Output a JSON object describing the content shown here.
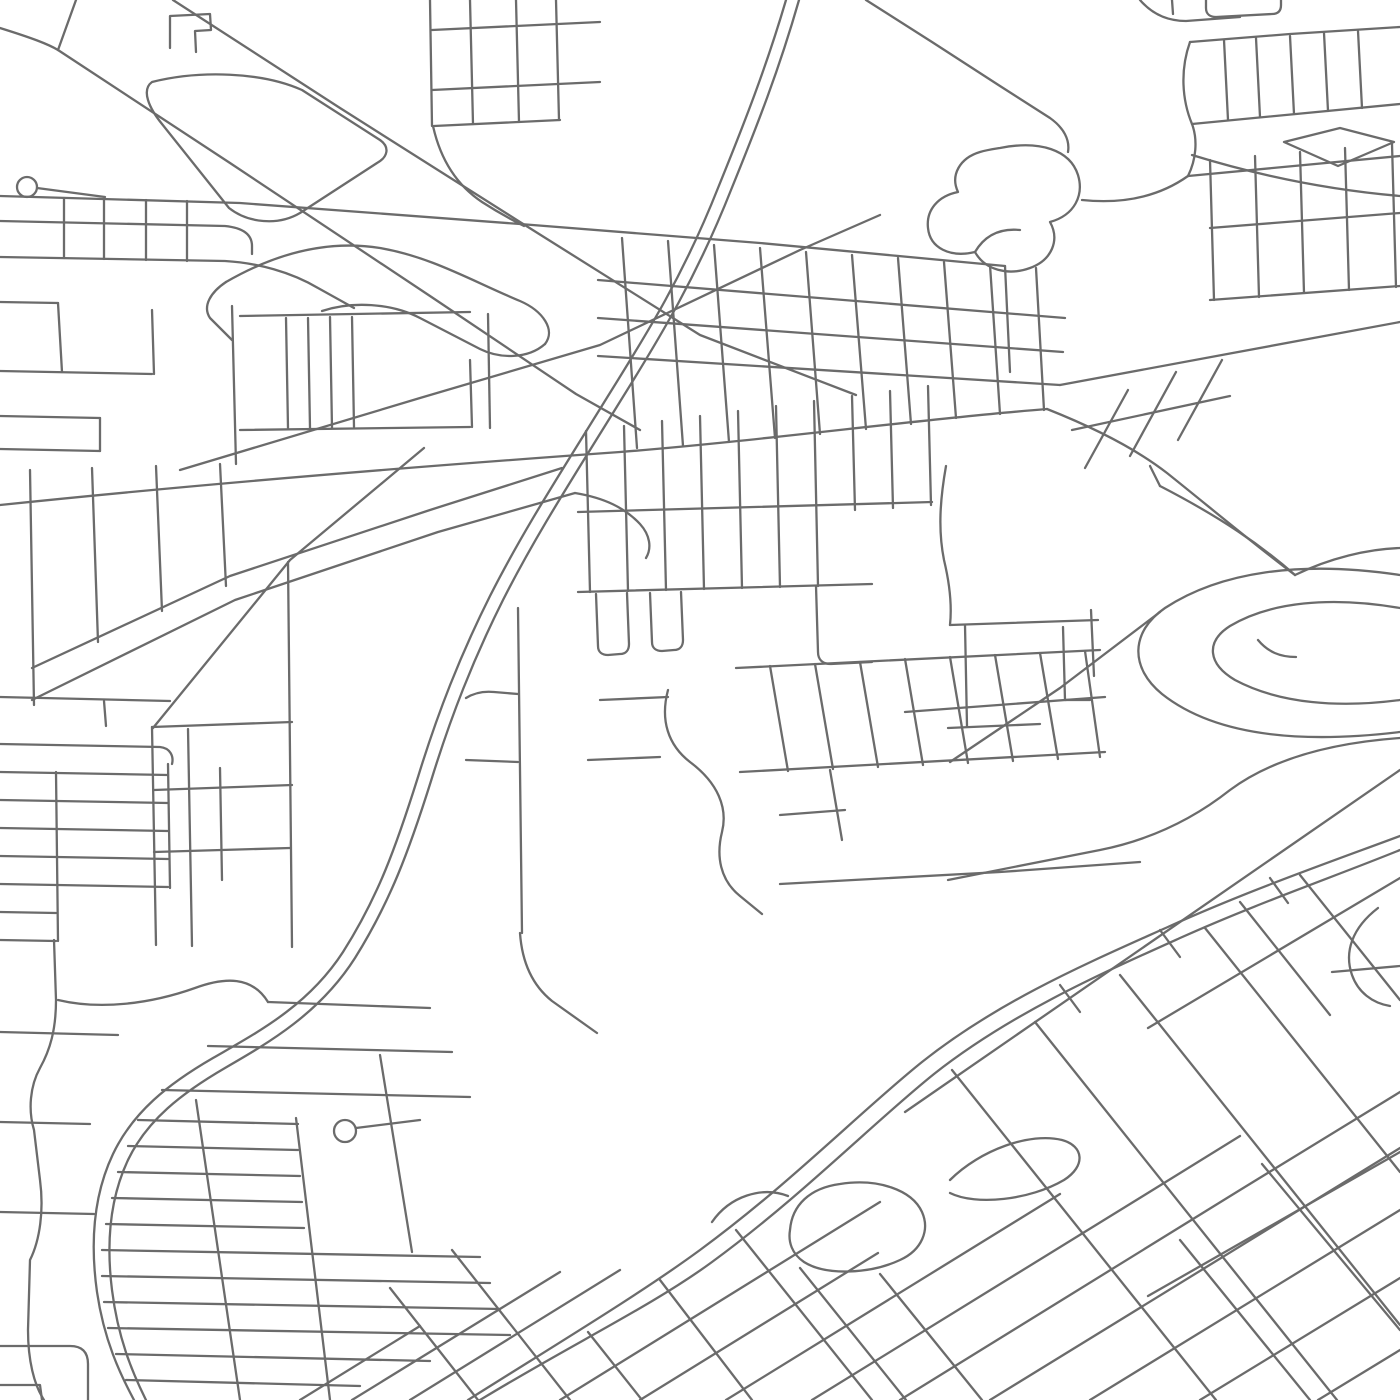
{
  "map": {
    "background_color": "#ffffff",
    "road_color": "#6b6b6b",
    "road_width": 2.3,
    "canvas": {
      "width": 1400,
      "height": 1400
    },
    "cul_de_sacs": [
      {
        "cx": 27,
        "cy": 187,
        "r": 10
      },
      {
        "cx": 345,
        "cy": 1131,
        "r": 11
      }
    ],
    "roads": [
      "M 786 0 C 766 68 744 124 718 188 C 684 274 648 332 608 396 C 558 477 523 531 490 596 C 460 656 438 712 418 777 C 396 847 378 897 343 952 C 308 1006 258 1032 213 1058 C 168 1084 133 1112 113 1154 C 94 1194 90 1242 97 1292 C 104 1340 120 1374 134 1400",
      "M 799 0 C 779 70 757 126 731 190 C 697 276 661 336 621 400 C 571 481 536 535 503 600 C 473 660 451 716 431 781 C 409 851 390 902 355 958 C 320 1013 270 1042 225 1068 C 182 1093 147 1120 128 1160 C 110 1198 106 1242 112 1290 C 118 1338 132 1372 146 1400",
      "M 468 1400 C 560 1342 640 1294 700 1250 C 790 1184 862 1110 922 1062 C 1000 1000 1090 962 1170 926 C 1250 890 1330 862 1400 836",
      "M 480 1400 C 572 1344 652 1306 712 1262 C 802 1196 874 1122 934 1074 C 1010 1014 1100 974 1180 938 C 1258 903 1336 876 1400 850",
      "M 905 1112 L 1400 770",
      "M 1160 612 L 1060 688 L 950 762",
      "M 0 505 C 240 480 480 462 620 452 C 760 441 920 419 1047 409",
      "M 1047 409 C 1100 430 1140 452 1167 473 C 1212 509 1256 546 1295 575",
      "M 1060 385 C 1160 367 1300 340 1400 322",
      "M 0 196 L 240 203 L 520 224 L 760 243 L 1005 266",
      "M 1005 266 L 1010 372",
      "M 598 280 L 1065 318",
      "M 598 318 L 1063 352",
      "M 598 356 L 1060 385",
      "M 622 238 L 637 448",
      "M 668 241 L 683 446",
      "M 714 245 L 729 442",
      "M 760 248 L 775 438",
      "M 806 252 L 820 434",
      "M 852 255 L 866 429",
      "M 898 258 L 911 424",
      "M 944 262 L 956 418",
      "M 990 265 L 1000 414",
      "M 1036 268 L 1044 410",
      "M 1085 468 L 1128 390",
      "M 1130 456 L 1176 372",
      "M 1178 440 L 1222 360",
      "M 1072 430 L 1230 396",
      "M 430 0 L 432 126",
      "M 470 0 L 473 124",
      "M 516 0 L 519 122",
      "M 556 0 L 559 120",
      "M 432 30 L 600 22",
      "M 432 90 L 600 82",
      "M 434 126 L 560 120",
      "M 433 126 C 441 162 458 186 482 202 C 496 211 510 219 524 226",
      "M 170 48 L 170 16 L 210 14 L 211 30 L 195 31 L 196 52",
      "M 0 28 C 32 38 48 44 58 50 L 230 163 L 430 296 L 576 394 L 640 430",
      "M 76 0 L 58 50",
      "M 173 0 L 340 108 L 520 222 L 700 335 L 856 395",
      "M 180 470 L 420 398 L 600 345 L 800 250 L 880 215",
      "M 152 82 C 200 70 262 72 302 90 L 380 140 C 390 147 388 157 377 163 L 300 213 C 278 226 248 223 229 208 L 162 124 C 149 108 141 90 152 82 Z",
      "M 226 282 C 278 252 330 240 380 248 C 432 257 472 281 520 301 C 543 311 556 330 545 344",
      "M 226 282 C 211 292 202 306 210 318 L 232 340",
      "M 545 344 C 528 359 500 359 480 349 L 420 318 C 391 303 352 301 322 311",
      "M 37 188 L 105 197",
      "M 0 221 L 225 226 C 245 228 252 236 252 246 L 252 254",
      "M 0 257 L 225 261 C 258 263 291 272 318 288 L 354 308",
      "M 64 198 L 64 258",
      "M 104 199 L 104 259",
      "M 146 200 L 146 260",
      "M 187 201 L 187 261",
      "M 0 302 L 58 303",
      "M 58 303 L 62 372",
      "M 0 371 L 152 374",
      "M 152 310 L 154 374",
      "M 0 416 L 100 418",
      "M 0 449 L 100 451",
      "M 100 418 L 100 451",
      "M 232 306 L 236 464",
      "M 240 316 L 470 312",
      "M 240 430 L 470 427",
      "M 286 318 L 288 428",
      "M 308 318 L 310 428",
      "M 330 317 L 332 428",
      "M 352 317 L 354 427",
      "M 470 360 L 472 427",
      "M 488 314 L 490 428",
      "M 30 470 L 34 705",
      "M 92 468 L 98 642",
      "M 156 466 L 162 611",
      "M 220 464 L 226 586",
      "M 32 668 L 230 576 L 430 510 L 562 468",
      "M 32 700 L 235 600 L 438 532 L 575 493",
      "M 575 493 C 605 498 625 508 640 524 C 650 535 652 548 646 558",
      "M 0 697 L 170 701",
      "M 104 701 L 106 726",
      "M 0 744 L 160 747 C 170 748 174 756 172 764",
      "M 0 772 L 168 775",
      "M 0 800 L 168 803",
      "M 0 828 L 168 831",
      "M 0 856 L 168 859",
      "M 0 884 L 168 887",
      "M 0 912 L 56 913",
      "M 0 940 L 56 941",
      "M 56 772 L 58 941",
      "M 168 764 L 170 888",
      "M 152 727 L 292 722",
      "M 154 790 L 292 785",
      "M 154 852 L 290 848",
      "M 152 727 L 156 945",
      "M 188 729 L 192 946",
      "M 288 562 L 292 947",
      "M 153 728 L 290 560 L 424 448",
      "M 220 768 L 222 880",
      "M 518 608 L 522 933",
      "M 466 698 C 474 693 484 691 494 692 L 518 694",
      "M 466 760 L 518 762",
      "M 520 933 C 522 962 532 985 552 1001 L 597 1033",
      "M 578 512 L 932 502",
      "M 578 592 L 872 584",
      "M 586 431 L 590 592",
      "M 624 426 L 628 591",
      "M 662 421 L 666 590",
      "M 700 416 L 704 589",
      "M 738 411 L 742 588",
      "M 776 406 L 780 587",
      "M 814 401 L 818 586",
      "M 852 396 L 855 510",
      "M 890 391 L 893 508",
      "M 928 386 L 931 505",
      "M 596 594 L 598 646 C 598 652 602 655 608 655 L 620 654 C 626 654 629 650 629 644 L 627 593",
      "M 650 593 L 652 642 C 652 648 656 651 662 651 L 674 650 C 680 650 683 646 683 640 L 681 592",
      "M 816 586 L 818 652 C 818 660 823 664 831 664 L 872 662",
      "M 668 690 C 660 720 668 745 690 762 C 718 783 728 808 722 832 C 716 856 720 880 740 896 L 762 914",
      "M 600 700 L 668 697",
      "M 588 760 L 660 757",
      "M 736 668 L 1100 650",
      "M 740 772 L 1105 752",
      "M 770 666 L 788 771",
      "M 815 664 L 833 769",
      "M 860 662 L 878 767",
      "M 905 659 L 923 765",
      "M 950 657 L 968 763",
      "M 995 655 L 1013 761",
      "M 1040 653 L 1058 759",
      "M 1085 651 L 1100 757",
      "M 905 712 L 1105 697",
      "M 780 815 L 845 810",
      "M 780 884 L 1000 872 L 1140 862",
      "M 830 770 L 842 840",
      "M 946 466 C 940 500 938 530 944 560 C 950 585 952 606 950 625",
      "M 950 625 L 1098 620",
      "M 1091 610 L 1094 676",
      "M 965 625 L 967 726",
      "M 948 728 L 1040 724",
      "M 1063 627 L 1065 700 L 1090 700",
      "M 1400 575 C 1300 560 1220 572 1165 608 C 1130 632 1130 668 1162 694 C 1215 736 1300 744 1400 732",
      "M 1400 608 C 1330 596 1270 602 1230 626 C 1205 642 1208 664 1235 680 C 1280 704 1340 708 1400 700",
      "M 1258 640 C 1268 652 1280 657 1296 657",
      "M 1160 486 C 1222 518 1262 546 1295 575",
      "M 1295 575 C 1330 558 1368 549 1400 548",
      "M 948 880 L 1100 850 C 1150 840 1192 820 1230 790 C 1272 759 1330 743 1400 738",
      "M 1160 486 L 1150 466",
      "M 1206 0 L 1206 8 C 1206 14 1210 17 1216 17 L 1272 14 C 1278 14 1281 11 1281 5 L 1281 0",
      "M 1140 0 C 1152 14 1168 21 1186 21 L 1240 17",
      "M 1172 0 L 1173 14",
      "M 1190 42 C 1180 70 1182 100 1192 124 C 1198 140 1196 160 1188 176",
      "M 1190 42 L 1290 34 L 1400 27",
      "M 1224 40 L 1228 120",
      "M 1256 38 L 1260 117",
      "M 1290 36 L 1294 114",
      "M 1324 33 L 1328 111",
      "M 1358 31 L 1362 108",
      "M 1192 124 L 1400 104",
      "M 1188 176 L 1400 156",
      "M 1284 142 L 1340 128 L 1394 142 L 1338 166 Z",
      "M 1192 155 C 1260 176 1330 190 1400 196",
      "M 866 0 L 932 42 L 1000 86 L 1050 118 C 1064 128 1070 140 1068 152",
      "M 1000 148 C 1040 140 1070 150 1078 175 C 1084 195 1075 215 1050 222 C 1060 240 1052 260 1030 268 C 1008 276 985 270 975 252 C 950 258 930 248 928 228 C 926 210 938 196 958 192 C 950 175 960 158 980 152 C 987 150 994 149 1000 148 Z",
      "M 975 252 C 985 235 1000 228 1020 230",
      "M 1082 200 C 1130 205 1164 193 1188 176",
      "M 1210 160 L 1214 300",
      "M 1255 156 L 1259 297",
      "M 1300 152 L 1304 293",
      "M 1345 148 L 1349 290",
      "M 1392 144 L 1396 287",
      "M 1210 228 L 1400 213",
      "M 1210 300 L 1400 286",
      "M 54 940 L 56 1000 C 56 1030 50 1050 40 1068 C 30 1086 28 1110 34 1130 L 40 1180 C 44 1210 40 1240 30 1260 L 28 1330 C 28 1360 34 1385 44 1400",
      "M 0 1032 L 118 1035",
      "M 0 1122 L 90 1124",
      "M 0 1212 L 94 1214",
      "M 0 1346 L 70 1346 C 82 1346 88 1352 88 1364 L 88 1400",
      "M 0 1385 L 40 1385 L 42 1400",
      "M 58 1000 C 100 1010 150 1004 195 988 C 225 977 252 976 268 1002",
      "M 268 1002 L 430 1008",
      "M 208 1046 L 452 1052",
      "M 162 1090 L 470 1097",
      "M 138 1120 L 298 1124",
      "M 128 1146 L 298 1150",
      "M 118 1172 L 300 1176",
      "M 112 1198 L 302 1202",
      "M 106 1224 L 304 1228",
      "M 102 1250 L 480 1257",
      "M 102 1276 L 490 1283",
      "M 104 1302 L 500 1309",
      "M 108 1328 L 510 1335",
      "M 116 1354 L 430 1361",
      "M 126 1380 L 360 1386",
      "M 196 1100 L 240 1400",
      "M 296 1118 L 330 1400",
      "M 380 1055 L 412 1252",
      "M 356 1128 L 420 1120",
      "M 300 1400 L 420 1326",
      "M 352 1400 L 560 1272",
      "M 410 1400 L 620 1270",
      "M 560 1400 L 880 1202",
      "M 640 1400 L 878 1253",
      "M 726 1400 L 940 1268 L 1060 1194",
      "M 812 1400 L 1130 1204 L 1240 1136",
      "M 900 1400 L 1240 1190 L 1400 1092",
      "M 990 1400 L 1400 1148",
      "M 1090 1400 L 1400 1210",
      "M 1200 1400 L 1400 1278",
      "M 1318 1400 L 1400 1350",
      "M 1148 1028 L 1400 878",
      "M 1148 1296 L 1400 1152",
      "M 390 1288 L 478 1400",
      "M 452 1250 L 570 1400",
      "M 588 1332 L 642 1400",
      "M 660 1280 L 752 1400",
      "M 736 1230 L 872 1400",
      "M 800 1268 L 906 1400",
      "M 880 1274 L 982 1400",
      "M 952 1070 L 1216 1400",
      "M 1035 1022 L 1337 1400",
      "M 1120 975 L 1400 1325",
      "M 1205 928 L 1400 1172",
      "M 1300 875 L 1400 1000",
      "M 1240 902 L 1330 1015",
      "M 1180 1240 L 1310 1400",
      "M 1262 1164 L 1400 1330",
      "M 1060 985 L 1080 1012",
      "M 1160 930 L 1180 957",
      "M 1270 878 L 1288 903",
      "M 790 1230 C 792 1205 810 1188 840 1184 C 878 1178 912 1190 922 1212 C 930 1230 922 1250 900 1260 C 870 1274 826 1276 804 1262 C 792 1254 788 1242 790 1230 Z",
      "M 712 1222 C 730 1196 762 1186 788 1196",
      "M 950 1180 C 980 1150 1030 1132 1062 1140 C 1084 1146 1086 1166 1064 1180 C 1030 1200 976 1206 950 1193",
      "M 1378 908 C 1352 928 1344 952 1352 975 C 1358 992 1372 1003 1390 1006",
      "M 1332 972 L 1400 966"
    ]
  }
}
